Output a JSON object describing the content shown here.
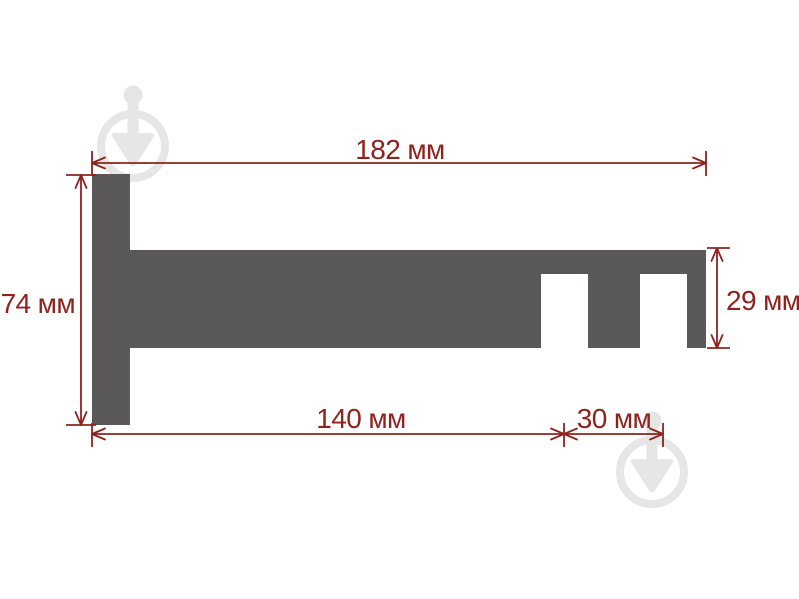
{
  "diagram": {
    "kind": "technical-dimension-drawing",
    "subject": "curtain-rod-bracket-side-profile",
    "unit": "мм",
    "colors": {
      "background": "#ffffff",
      "shape": "#5a5858",
      "dimension": "#8e221d",
      "watermark": "#e6e6e6"
    },
    "dimensions": {
      "total_width": {
        "label": "182 мм",
        "value": 182,
        "orientation": "horizontal",
        "position": "top"
      },
      "left_height": {
        "label": "74 мм",
        "value": 74,
        "orientation": "vertical",
        "position": "left"
      },
      "right_height": {
        "label": "29 мм",
        "value": 29,
        "orientation": "vertical",
        "position": "right"
      },
      "bottom_length": {
        "label": "140 мм",
        "value": 140,
        "orientation": "horizontal",
        "position": "bottom"
      },
      "slot_pitch": {
        "label": "30 мм",
        "value": 30,
        "orientation": "horizontal",
        "position": "bottom-right"
      }
    }
  }
}
